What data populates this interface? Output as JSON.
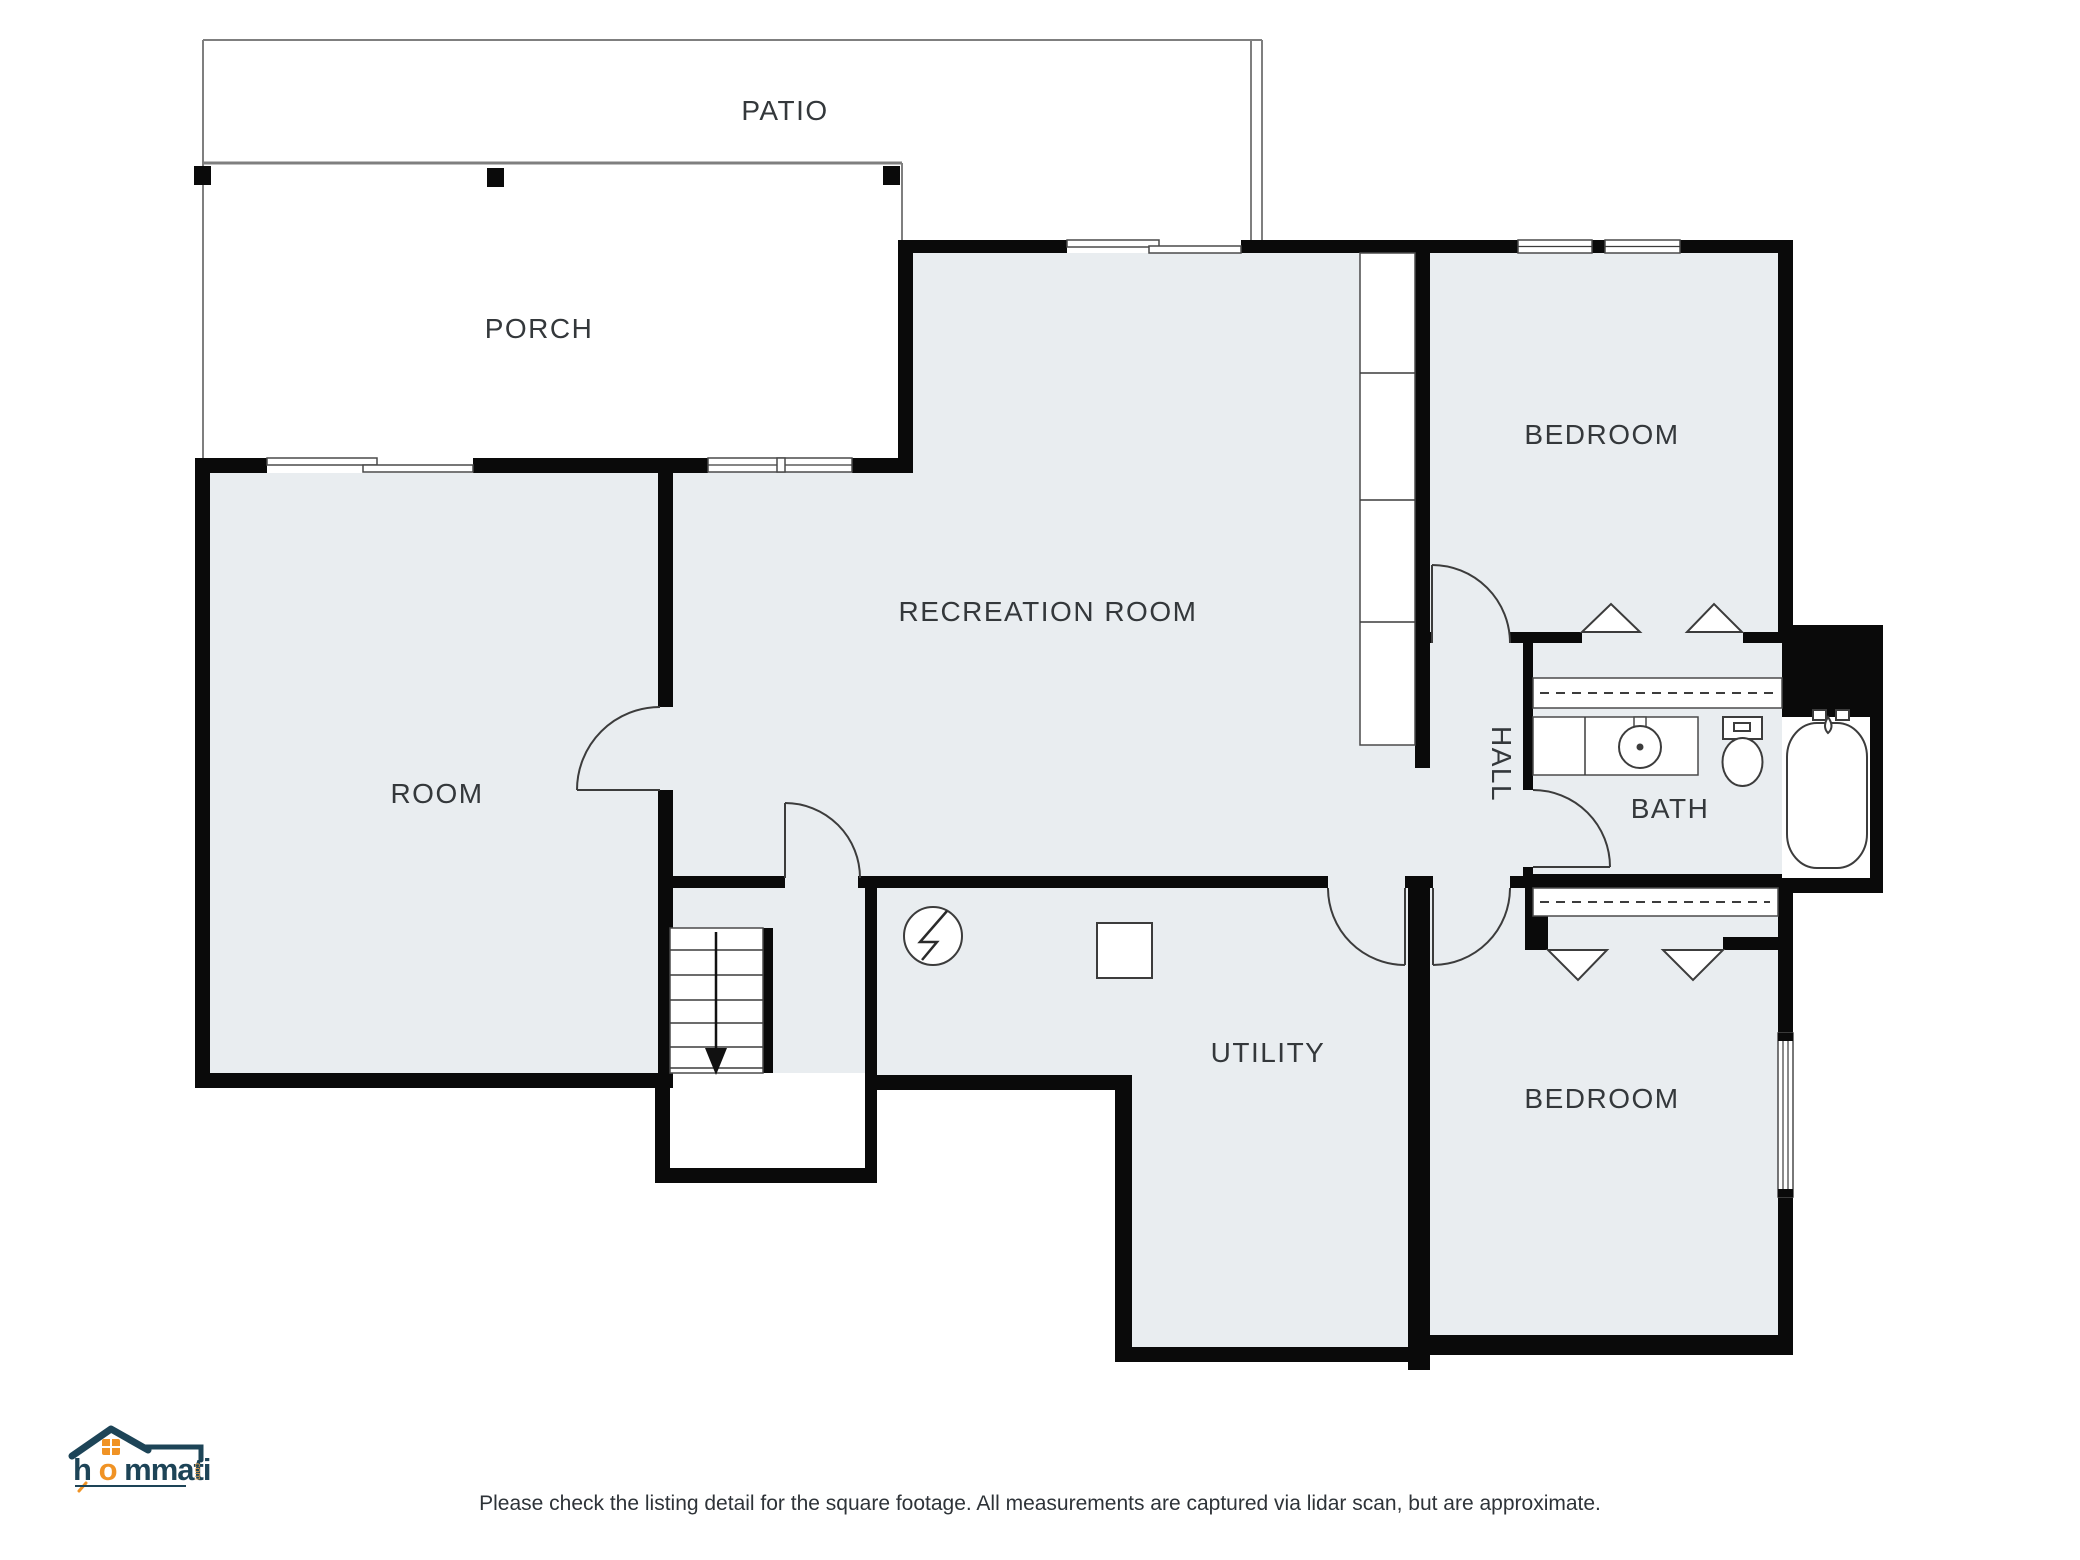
{
  "plan": {
    "rooms": [
      {
        "id": "patio",
        "label": "PATIO"
      },
      {
        "id": "porch",
        "label": "PORCH"
      },
      {
        "id": "room",
        "label": "ROOM"
      },
      {
        "id": "recreation-room",
        "label": "RECREATION ROOM"
      },
      {
        "id": "bedroom-top",
        "label": "BEDROOM"
      },
      {
        "id": "hall",
        "label": "HALL"
      },
      {
        "id": "bath",
        "label": "BATH"
      },
      {
        "id": "utility",
        "label": "UTILITY"
      },
      {
        "id": "bedroom-bottom",
        "label": "BEDROOM"
      }
    ],
    "symbols": {
      "furnace": "circle-lightning-icon",
      "water_heater": "square-box-icon",
      "stairs": "treads-with-down-arrow"
    },
    "colors": {
      "floor_fill": "#e9edf0",
      "wall": "#0a0a0a",
      "label_text": "#34383b",
      "outdoor_lines": "#7f7f7f"
    }
  },
  "footer": {
    "logo": {
      "brand_lead": "h",
      "brand_accent": "o",
      "brand_rest": "mmati",
      "brand_suffix": "com",
      "navy": "#1d4457",
      "orange": "#f09325"
    },
    "disclaimer": "Please check the listing detail for the square footage. All measurements are captured via lidar scan, but are approximate."
  }
}
